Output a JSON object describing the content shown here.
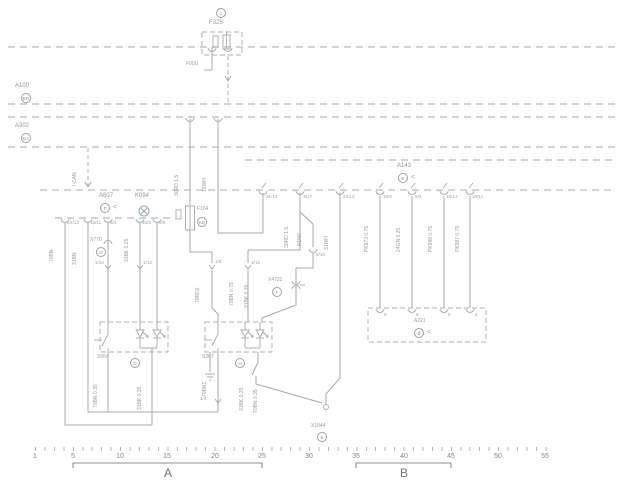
{
  "glyphs": {
    "pointer": "<"
  },
  "f325": {
    "badge": "1",
    "label": "F325",
    "pin_left_label": "F90U"
  },
  "buses": {
    "a100": {
      "label": "A100",
      "badge": "BR"
    },
    "a302": {
      "label": "A302",
      "badge": "BA"
    }
  },
  "can_label": "I-CAN",
  "a607": {
    "label": "A607",
    "badge": "F"
  },
  "k094": {
    "label": "K094"
  },
  "f164": {
    "label": "F164",
    "badge": "KB"
  },
  "a143": {
    "label": "A143",
    "badge": "E"
  },
  "a221": {
    "label": "A221",
    "badge": "B",
    "pins": [
      "8",
      "9",
      "5",
      "4"
    ]
  },
  "x770": {
    "label": "X770",
    "badge": "D"
  },
  "x4722": {
    "label": "X4722",
    "badge": "F"
  },
  "s954": {
    "label": "S954",
    "badge": "D"
  },
  "s267": {
    "label": "S267",
    "badge": "H"
  },
  "x1844": {
    "label": "X1844",
    "badge": "B"
  },
  "left_pins": [
    "6X/13",
    "15/11",
    "6/1",
    "15/3",
    "6/5"
  ],
  "mid_pins": [
    "31/18",
    "31/7",
    "23/12",
    "5/10"
  ],
  "a143_pins": [
    "15/8",
    "8/4",
    "10/13",
    "10/11"
  ],
  "inner_pins": {
    "x770_a": "1/10",
    "x770_b": "1/12",
    "mid_a": "1/8",
    "mid_b": "1/12",
    "s267": "1/4"
  },
  "wire_labels": {
    "top_feed": "30RD 1.5",
    "top_feed2": "16WH",
    "mid_feed": "30RD 1.5",
    "mid_feed2": "RD90",
    "mid_feed3": "31WH",
    "a143_w1": "PK973 0.75",
    "a143_w2": "24GN 0.25",
    "a143_w3": "PK988 0.75",
    "a143_w4": "PK987 0.75",
    "left_w1": "70BN",
    "left_w2": "31BN",
    "x770_w": "31BK 0.25",
    "mid_w1": "70RD2",
    "mid_w2": "70BN 0.75",
    "mid_w3": "31BK 0.35",
    "s954_w1": "70BN 0.35",
    "s954_w2": "31BK 0.35",
    "s267_w1": "70BN1",
    "s267_w2": "31BK 0.35",
    "s267_w3": "70BN 0.35"
  },
  "ruler": {
    "numbers": [
      "1",
      "5",
      "10",
      "15",
      "20",
      "25",
      "30",
      "35",
      "40",
      "45",
      "50",
      "55"
    ],
    "section_a": "A",
    "section_b": "B"
  }
}
